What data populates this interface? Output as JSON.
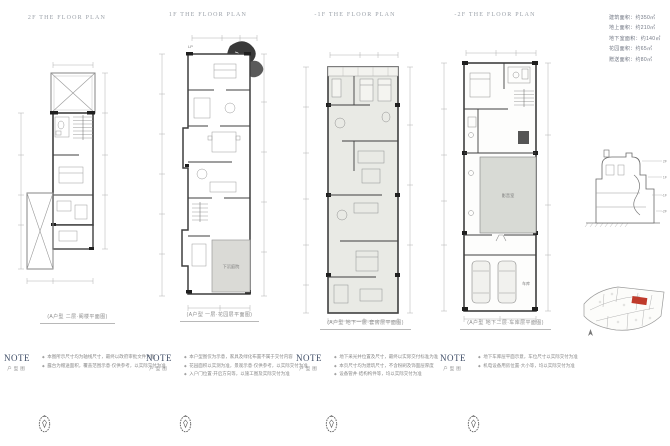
{
  "area_info": {
    "lines": [
      "建筑面积：约350㎡",
      "地上面积：约210㎡",
      "地下室面积：约140㎡",
      "花园面积：约65㎡",
      "赠送面积：约80㎡"
    ]
  },
  "panels": [
    {
      "title": "2F THE FLOOR PLAN",
      "caption": "(A户型 二层·阁楼平面图)",
      "note_label": "NOTE",
      "note_sub": "户型图",
      "notes": [
        "本图所示尺寸均为轴线尺寸，最终以政府审批文件为准",
        "露台为赠送面积，覆盖范围示意·仅供参考，以实际交付为准"
      ]
    },
    {
      "title": "1F THE FLOOR PLAN",
      "caption": "(A户型 一层·花园层平面图)",
      "note_label": "NOTE",
      "note_sub": "户型图",
      "notes": [
        "本户型图仅为示意，家具及绿化布置不属于交付内容",
        "花园面积以实测为准，景观示意·仅供参考，以实际交付为准",
        "入户门位置·开启方向等，以施工图及实际交付为准"
      ],
      "plan_labels": {
        "lp": "LP",
        "courtyard": "下沉庭院"
      }
    },
    {
      "title": "-1F THE FLOOR PLAN",
      "caption": "(A户型 地下一层·套房层平面图)",
      "note_label": "NOTE",
      "note_sub": "户型图",
      "notes": [
        "地下采光井位置及尺寸，最终以实际交付标准为准",
        "本页尺寸均为建筑尺寸，不含粉刷及饰面层厚度",
        "设备管井·结构构件等，均以实际交付为准"
      ]
    },
    {
      "title": "-2F THE FLOOR PLAN",
      "caption": "(A户型 地下二层·车库层平面图)",
      "note_label": "NOTE",
      "note_sub": "户型图",
      "notes": [
        "地下车库层平面示意，车位尺寸以实际交付为准",
        "机电设备用房位置·大小等，均以实际交付为准"
      ],
      "plan_labels": {
        "av_room": "影音室",
        "garage": "车库"
      }
    }
  ],
  "section": {
    "levels": [
      "2F",
      "1F",
      "-1F",
      "-2F"
    ]
  },
  "colors": {
    "wall": "#3f3f3f",
    "thin_line": "#9a9a9a",
    "basement_fill": "#e9eae5",
    "gray_room_fill": "#d8dad5",
    "tree_fill": "#3a3a3a",
    "map_highlight": "#bf3a2b"
  }
}
